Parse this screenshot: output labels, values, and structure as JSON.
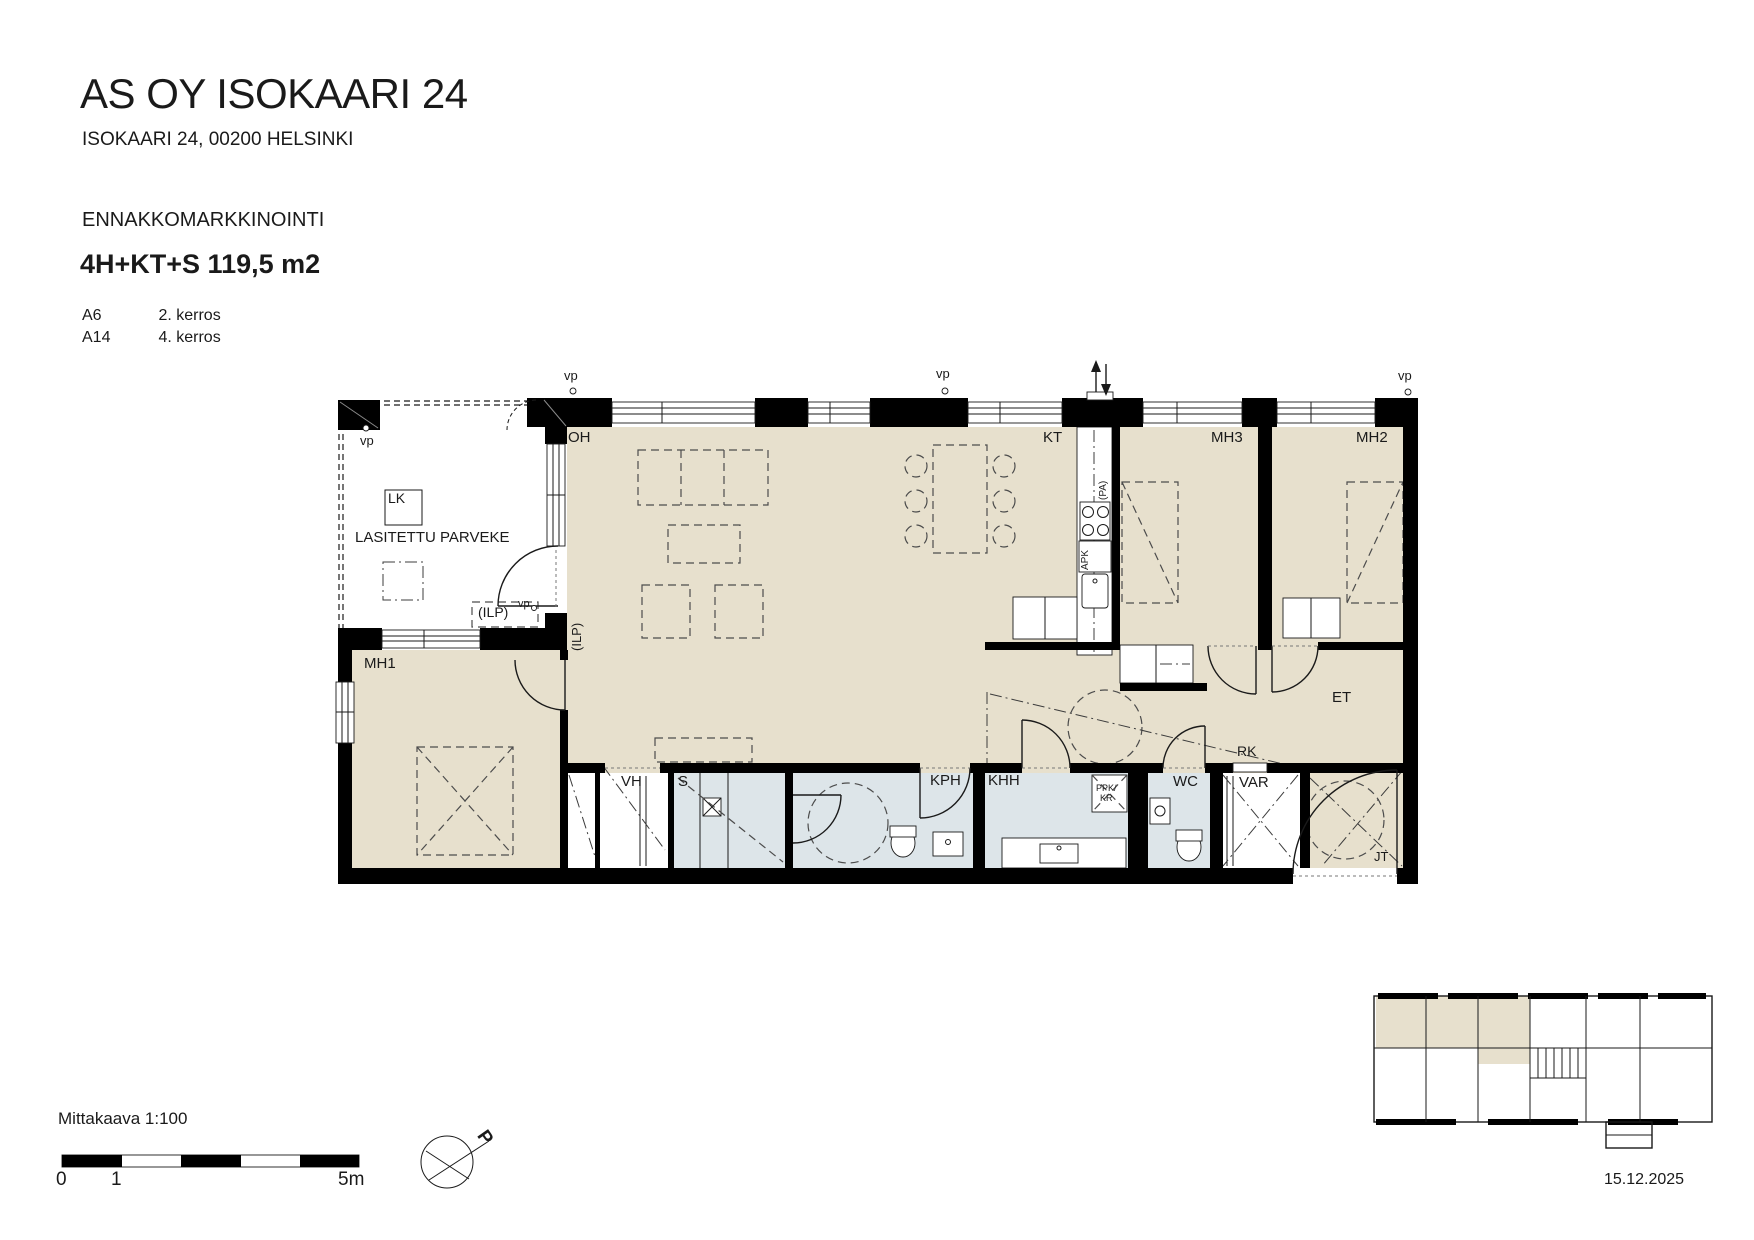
{
  "header": {
    "title": "AS OY ISOKAARI 24",
    "address": "ISOKAARI 24, 00200 HELSINKI",
    "marketing": "ENNAKKOMARKKINOINTI",
    "apartment_type": "4H+KT+S 119,5 m2",
    "units": [
      {
        "id": "A6",
        "floor": "2. kerros"
      },
      {
        "id": "A14",
        "floor": "4. kerros"
      }
    ]
  },
  "plan": {
    "labels": {
      "oh": "OH",
      "kt": "KT",
      "mh1": "MH1",
      "mh2": "MH2",
      "mh3": "MH3",
      "et": "ET",
      "vh": "VH",
      "sauna": "S",
      "kph": "KPH",
      "khh": "KHH",
      "wc": "WC",
      "var": "VAR",
      "rk": "RK",
      "jt": "JT",
      "lk": "LK",
      "balcony": "LASITETTU PARVEKE",
      "ilp": "(ILP)",
      "ilp_vertical": "(ILP)",
      "vp": "vp",
      "apk": "APK",
      "pa": "(PA)",
      "ppk": "PPK/",
      "kr": "KR"
    },
    "colors": {
      "room_fill": "#e7e0cd",
      "wet_room_fill": "#dde5e9",
      "wall": "#000000"
    }
  },
  "footer": {
    "scale_label": "Mittakaava 1:100",
    "scale_start": "0",
    "scale_mid": "1",
    "scale_end": "5m",
    "north_label": "P",
    "date": "15.12.2025"
  }
}
